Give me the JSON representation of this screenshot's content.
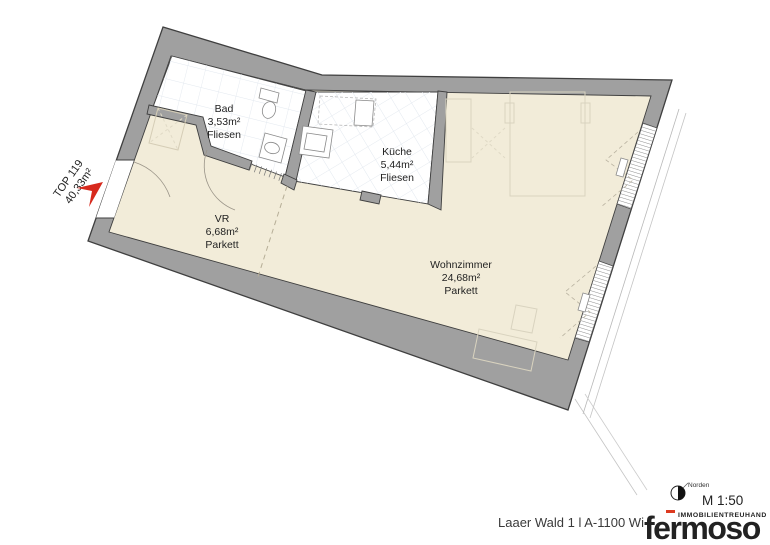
{
  "plan": {
    "unit": {
      "id": "TOP 119",
      "area": "40,33m²"
    },
    "rooms": [
      {
        "name": "Bad",
        "area": "3,53m²",
        "floor": "Fliesen"
      },
      {
        "name": "Küche",
        "area": "5,44m²",
        "floor": "Fliesen"
      },
      {
        "name": "VR",
        "area": "6,68m²",
        "floor": "Parkett"
      },
      {
        "name": "Wohnzimmer",
        "area": "24,68m²",
        "floor": "Parkett"
      }
    ]
  },
  "footer": {
    "address": "Laaer Wald 1 l A-1100 Wi",
    "scale": "M 1:50",
    "compass_label": "Norden",
    "logo": {
      "tagline": "IMMOBILIENTREUHAND",
      "brand": "fermoso"
    }
  },
  "colors": {
    "wall_gray": "#a0a0a0",
    "floor_beige": "#f2ecd9",
    "room_white": "#ffffff",
    "outline": "#3f3f3f",
    "arrow_red": "#d7291d",
    "logo_red": "#dd3a20"
  }
}
